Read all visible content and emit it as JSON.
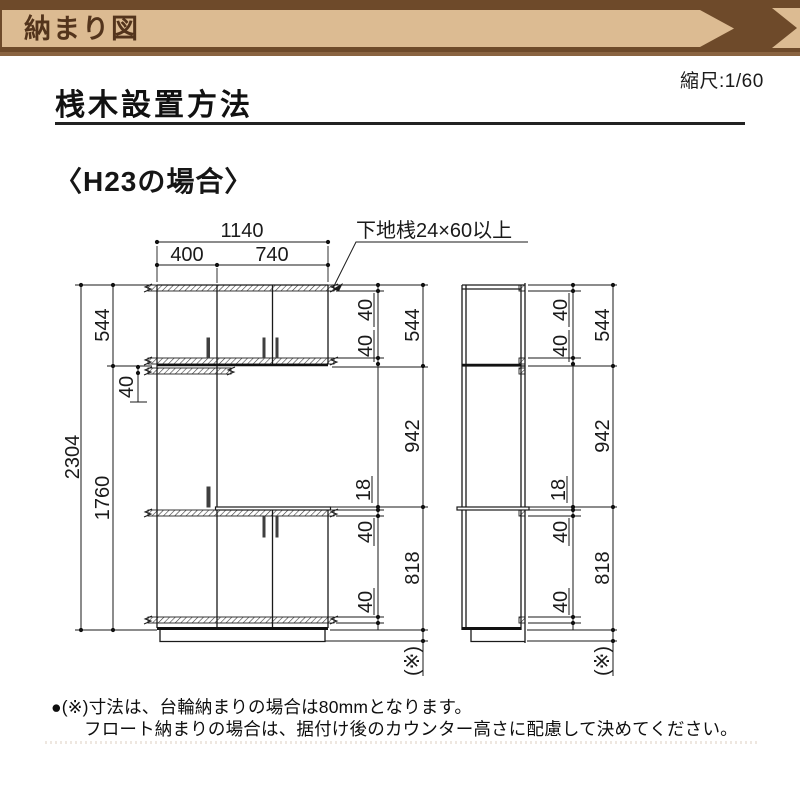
{
  "banner": {
    "title": "納まり図"
  },
  "header": {
    "scale_label": "縮尺:1/60",
    "title": "桟木設置方法",
    "case_label": "〈H23の場合〉"
  },
  "drawing": {
    "leader_label": "下地桟24×60以上",
    "dims": {
      "total_width": "1140",
      "left_width": "400",
      "right_width": "740",
      "upper_height": "544",
      "overall_height": "2304",
      "lower_height": "1760",
      "batten": "40",
      "counter_thickness": "18",
      "middle_height": "942",
      "base_height": "818",
      "asterisk_note": "(※)"
    }
  },
  "footnote": {
    "line1": "●(※)寸法は、台輪納まりの場合は80mmとなります。",
    "line2": "フロート納まりの場合は、据付け後のカウンター高さに配慮して決めてください。"
  },
  "colors": {
    "banner_dark": "#6e4a2a",
    "banner_tan": "#dcbb92",
    "banner_bottom": "#8a6441",
    "banner_text": "#53341c",
    "line": "#1a1a1a"
  }
}
